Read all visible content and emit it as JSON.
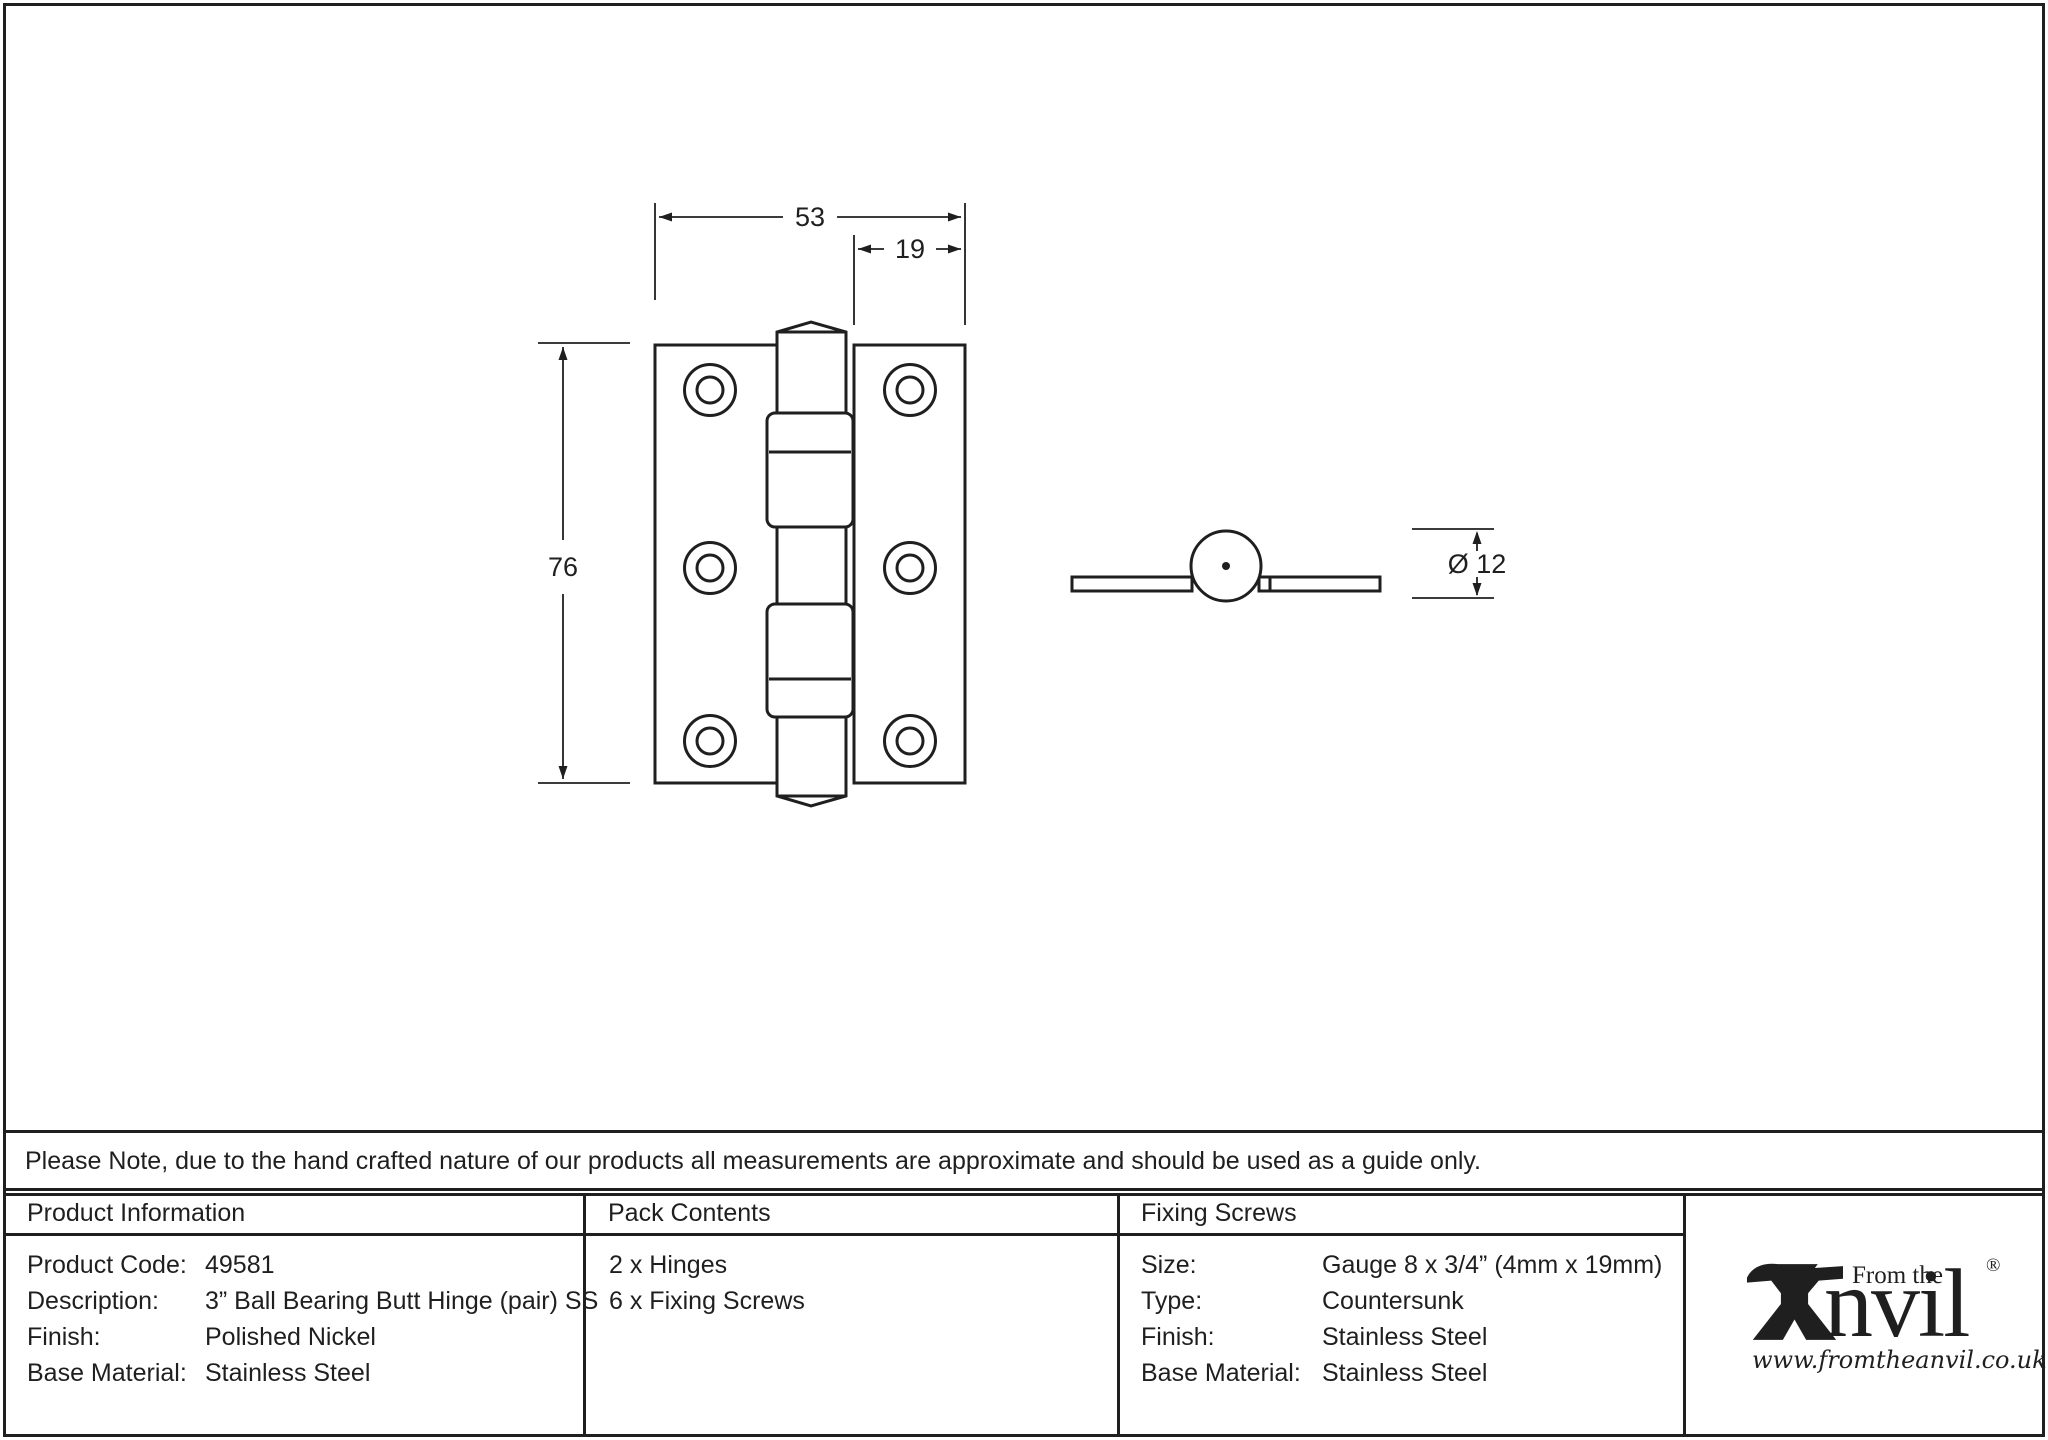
{
  "note": "Please Note, due to the hand crafted nature of our products all measurements are approximate and should be used as a guide only.",
  "drawing": {
    "dim_overall_width": "53",
    "dim_leaf_width": "19",
    "dim_height": "76",
    "dim_knuckle_diameter": "Ø 12"
  },
  "table": {
    "product_information": {
      "header": "Product Information",
      "rows": [
        {
          "label": "Product Code:",
          "value": "49581"
        },
        {
          "label": "Description:",
          "value": "3” Ball Bearing Butt Hinge (pair) SS"
        },
        {
          "label": "Finish:",
          "value": "Polished Nickel"
        },
        {
          "label": "Base Material:",
          "value": "Stainless Steel"
        }
      ]
    },
    "pack_contents": {
      "header": "Pack Contents",
      "items": [
        "2 x Hinges",
        "6 x Fixing Screws"
      ]
    },
    "fixing_screws": {
      "header": "Fixing Screws",
      "rows": [
        {
          "label": "Size:",
          "value": "Gauge 8 x 3/4” (4mm x 19mm)"
        },
        {
          "label": "Type:",
          "value": "Countersunk"
        },
        {
          "label": "Finish:",
          "value": "Stainless Steel"
        },
        {
          "label": "Base Material:",
          "value": "Stainless Steel"
        }
      ]
    }
  },
  "logo": {
    "tagline": "From the",
    "brand_suffix": "nvil",
    "registered_mark": "®",
    "url": "www.fromtheanvil.co.uk"
  },
  "colors": {
    "ink": "#1f1f1f",
    "paper": "#ffffff"
  }
}
